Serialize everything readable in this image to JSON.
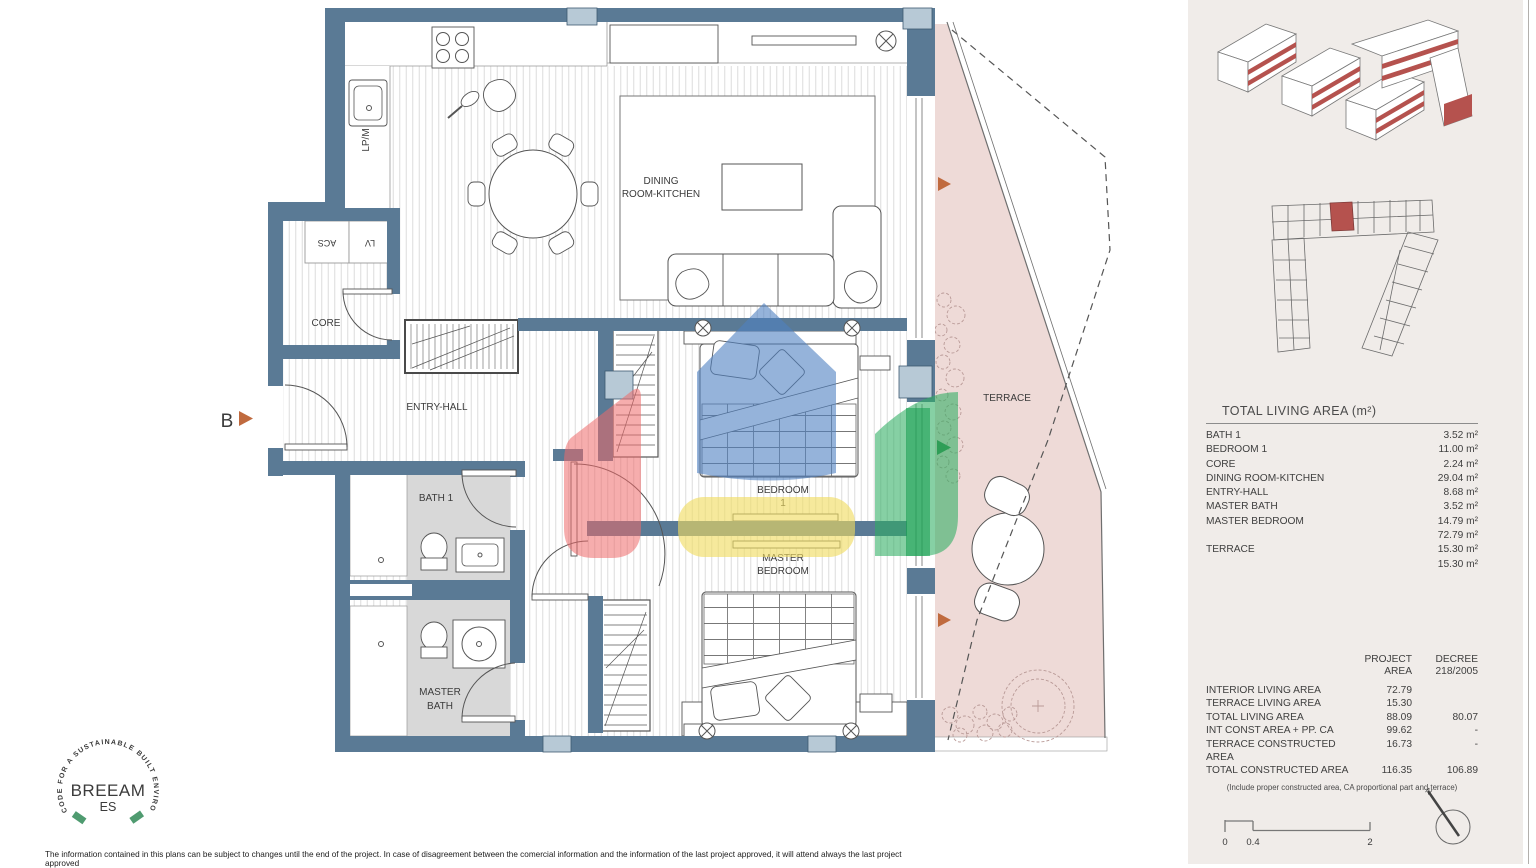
{
  "plan": {
    "labels": {
      "dining1": "DINING",
      "dining2": "ROOM-KITCHEN",
      "core": "CORE",
      "entry": "ENTRY-HALL",
      "bath1": "BATH 1",
      "mbath1": "MASTER",
      "mbath2": "BATH",
      "bed1a": "BEDROOM",
      "bed1b": "1",
      "mbed1": "MASTER",
      "mbed2": "BEDROOM",
      "terrace": "TERRACE",
      "lpm": "LP/M",
      "acs": "ACS",
      "lv": "LV",
      "section_b": "B"
    }
  },
  "sidebar": {
    "area_table": {
      "title": "TOTAL LIVING AREA (m²)",
      "rows": [
        {
          "label": "BATH 1",
          "value": "3.52 m²"
        },
        {
          "label": "BEDROOM 1",
          "value": "11.00 m²"
        },
        {
          "label": "CORE",
          "value": "2.24 m²"
        },
        {
          "label": "DINING ROOM-KITCHEN",
          "value": "29.04 m²"
        },
        {
          "label": "ENTRY-HALL",
          "value": "8.68 m²"
        },
        {
          "label": "MASTER BATH",
          "value": "3.52 m²"
        },
        {
          "label": "MASTER BEDROOM",
          "value": "14.79 m²"
        },
        {
          "label": "",
          "value": "72.79 m²"
        },
        {
          "label": "TERRACE",
          "value": "15.30 m²"
        },
        {
          "label": "",
          "value": "15.30 m²"
        }
      ]
    },
    "project_table": {
      "header": {
        "project1": "PROJECT",
        "project2": "AREA",
        "decree1": "DECREE",
        "decree2": "218/2005"
      },
      "rows": [
        {
          "label": "INTERIOR LIVING AREA",
          "project": "72.79",
          "decree": ""
        },
        {
          "label": "TERRACE LIVING AREA",
          "project": "15.30",
          "decree": ""
        },
        {
          "label": "TOTAL LIVING AREA",
          "project": "88.09",
          "decree": "80.07"
        },
        {
          "label": "INT CONST AREA + PP. CA",
          "project": "99.62",
          "decree": "-"
        },
        {
          "label": "TERRACE CONSTRUCTED AREA",
          "project": "16.73",
          "decree": "-"
        },
        {
          "label": "TOTAL CONSTRUCTED AREA",
          "project": "116.35",
          "decree": "106.89"
        }
      ],
      "footnote": "(Include proper constructed area, CA proportional part and terrace)"
    },
    "scale": {
      "t0": "0",
      "t1": "0.4",
      "t2": "2"
    },
    "north": "N"
  },
  "footer": {
    "breeam": {
      "name": "BREEAM",
      "region": "ES",
      "ring": "CODE FOR A SUSTAINABLE BUILT ENVIRONMENT"
    },
    "disclaimer": "The information contained in this plans can be subject to changes until the end of the project. In case of disagreement between the comercial information and the information of the last project approved, it will attend always the last project approved"
  },
  "colors": {
    "wall": "#5a7a95",
    "pillar": "#b7c9d6",
    "bath_tile": "#d8d8d8",
    "terrace_fill": "#eedad7",
    "overlay_red": "#ee6a6a",
    "overlay_blue": "#4e80c2",
    "overlay_yellow": "#f1dc60",
    "overlay_green": "#2fae62",
    "overlay_green_dark": "#149c4e",
    "marker_orange": "#c06a3e",
    "marker_green": "#2f9e57",
    "highlight_unit": "#b5524e",
    "breeam_green": "#4f9b70",
    "sidebar_bg": "#f0ece9"
  }
}
